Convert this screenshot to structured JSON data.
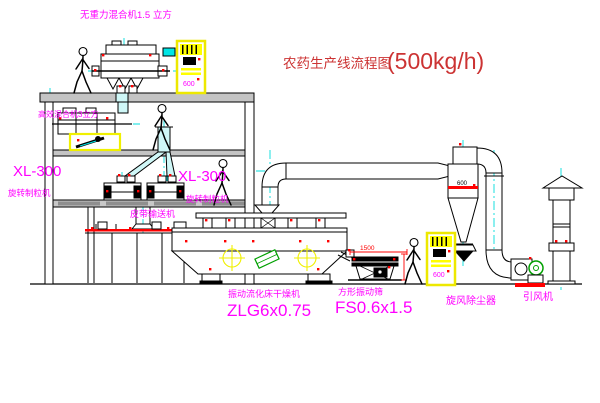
{
  "title": {
    "main": "农药生产线流程图",
    "capacity": "(500kg/h)"
  },
  "labels": {
    "gravity_mixer": "无重力混合机1.5 立方",
    "high_speed_mixer": "高效混合机3立方",
    "granulator_left_model": "XL-300",
    "granulator_left_name": "旋转制粒机",
    "granulator_right_model": "XL-300",
    "granulator_right_name": "旋转制粒机",
    "belt_conveyor": "皮带输送机",
    "dryer_name": "振动流化床干燥机",
    "dryer_model": "ZLG6x0.75",
    "sieve_name": "方形振动筛",
    "sieve_model": "FS0.6x1.5",
    "cyclone": "旋风除尘器",
    "fan": "引风机"
  },
  "dimensions": {
    "sieve_width": "1500",
    "cyclone_mark": "600",
    "cabinet_mark_left": "600",
    "cabinet_mark_right": "600"
  },
  "colors": {
    "label_magenta": "#ff00ff",
    "title_red": "#cc3333",
    "flange_red": "#ff0000",
    "cabinet_yellow": "#ffff00",
    "centerline_cyan": "#00dcdc",
    "motor_green": "#00a000",
    "slab_gray": "#c4c4c4",
    "line_black": "#000000"
  }
}
